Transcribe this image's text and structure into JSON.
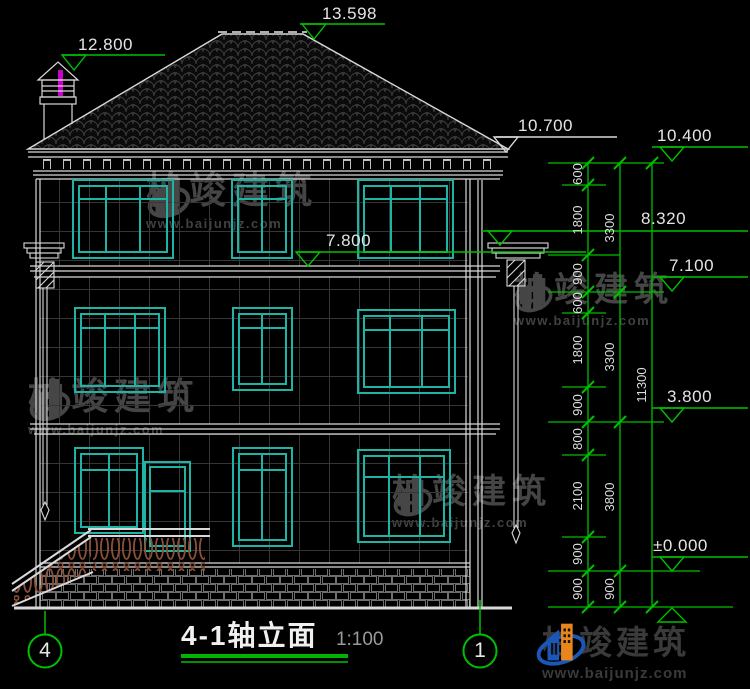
{
  "drawing": {
    "title": "4-1轴立面",
    "scale": "1:100",
    "axis_labels": [
      "4",
      "1"
    ],
    "elevation_markers": {
      "left": [
        "13.598",
        "12.800",
        "10.700",
        "8.320",
        "7.800"
      ],
      "right": [
        "10.400",
        "7.100",
        "3.800",
        "±0.000"
      ]
    },
    "dimensions": {
      "segments": [
        "600",
        "1800",
        "900",
        "600",
        "1800",
        "900",
        "800",
        "2100",
        "900",
        "900"
      ],
      "subtotals": [
        "3300",
        "3300",
        "3800",
        "900"
      ],
      "total": "11300"
    }
  },
  "watermark": {
    "brand": "柏竣建筑",
    "url": "www.baijunjz.com"
  },
  "logo": {
    "brand": "柏竣建筑",
    "url": "www.baijunjz.com"
  },
  "colors": {
    "line": "#d9d9d9",
    "dimension_green": "#00c000",
    "window_teal": "#1fb3a6",
    "baluster_brown": "#8a5038",
    "chimney_magenta": "#c800c8",
    "logo_blue": "#1a57b8",
    "logo_orange": "#e8851c"
  }
}
